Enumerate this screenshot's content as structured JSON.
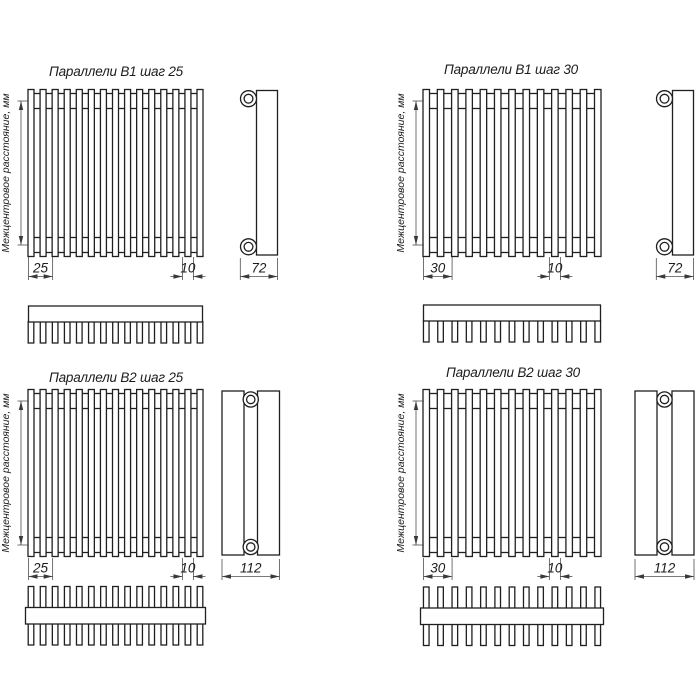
{
  "page": {
    "background": "#ffffff",
    "line_color": "#1f1f1f",
    "thin_line_color": "#4f4f4f"
  },
  "drawing": {
    "axis_label": "Межцентровое расстояние, мм",
    "variants": [
      {
        "id": "b1-step-25",
        "title": "Параллели В1 шаг 25",
        "series": "Параллели",
        "model": "В1",
        "step": 25,
        "tube_count": 15,
        "tube_rows": 1,
        "dims": {
          "pitch": "25",
          "tube_width": "10",
          "depth": "72"
        }
      },
      {
        "id": "b1-step-30",
        "title": "Параллели В1 шаг 30",
        "series": "Параллели",
        "model": "В1",
        "step": 30,
        "tube_count": 13,
        "tube_rows": 1,
        "dims": {
          "pitch": "30",
          "tube_width": "10",
          "depth": "72"
        }
      },
      {
        "id": "b2-step-25",
        "title": "Параллели В2 шаг 25",
        "series": "Параллели",
        "model": "В2",
        "step": 25,
        "tube_count": 15,
        "tube_rows": 2,
        "dims": {
          "pitch": "25",
          "tube_width": "10",
          "depth": "112"
        }
      },
      {
        "id": "b2-step-30",
        "title": "Параллели В2 шаг 30",
        "series": "Параллели",
        "model": "В2",
        "step": 30,
        "tube_count": 13,
        "tube_rows": 2,
        "dims": {
          "pitch": "30",
          "tube_width": "10",
          "depth": "112"
        }
      }
    ]
  }
}
